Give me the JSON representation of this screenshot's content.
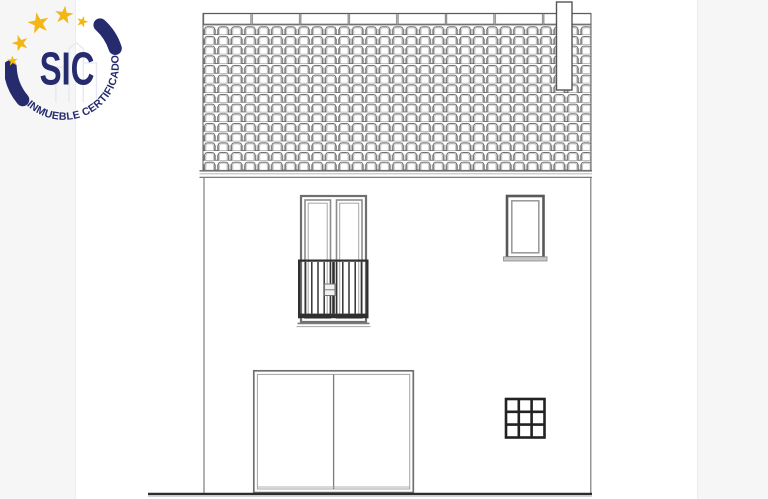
{
  "logo": {
    "acronym": "SIC",
    "tagline": "INMUEBLE CERTIFICADO",
    "colors": {
      "navy": "#262b6d",
      "gold": "#f3b715",
      "faint_building": "#e6e9f2"
    }
  },
  "drawing": {
    "subject": "house-front-elevation",
    "elements": [
      "tiled-roof",
      "ridge-caps",
      "eave-fascia",
      "chimney",
      "wall-outline",
      "balcony-door",
      "balcony-railing",
      "upper-window",
      "window-sill",
      "garage-door",
      "glass-block-window",
      "ground-line"
    ],
    "colors": {
      "paper": "#ffffff",
      "margin": "#f6f6f6",
      "line_dark": "#2d2d2d",
      "line_mid": "#6f6f6f",
      "line_light": "#a5a5a5"
    }
  }
}
